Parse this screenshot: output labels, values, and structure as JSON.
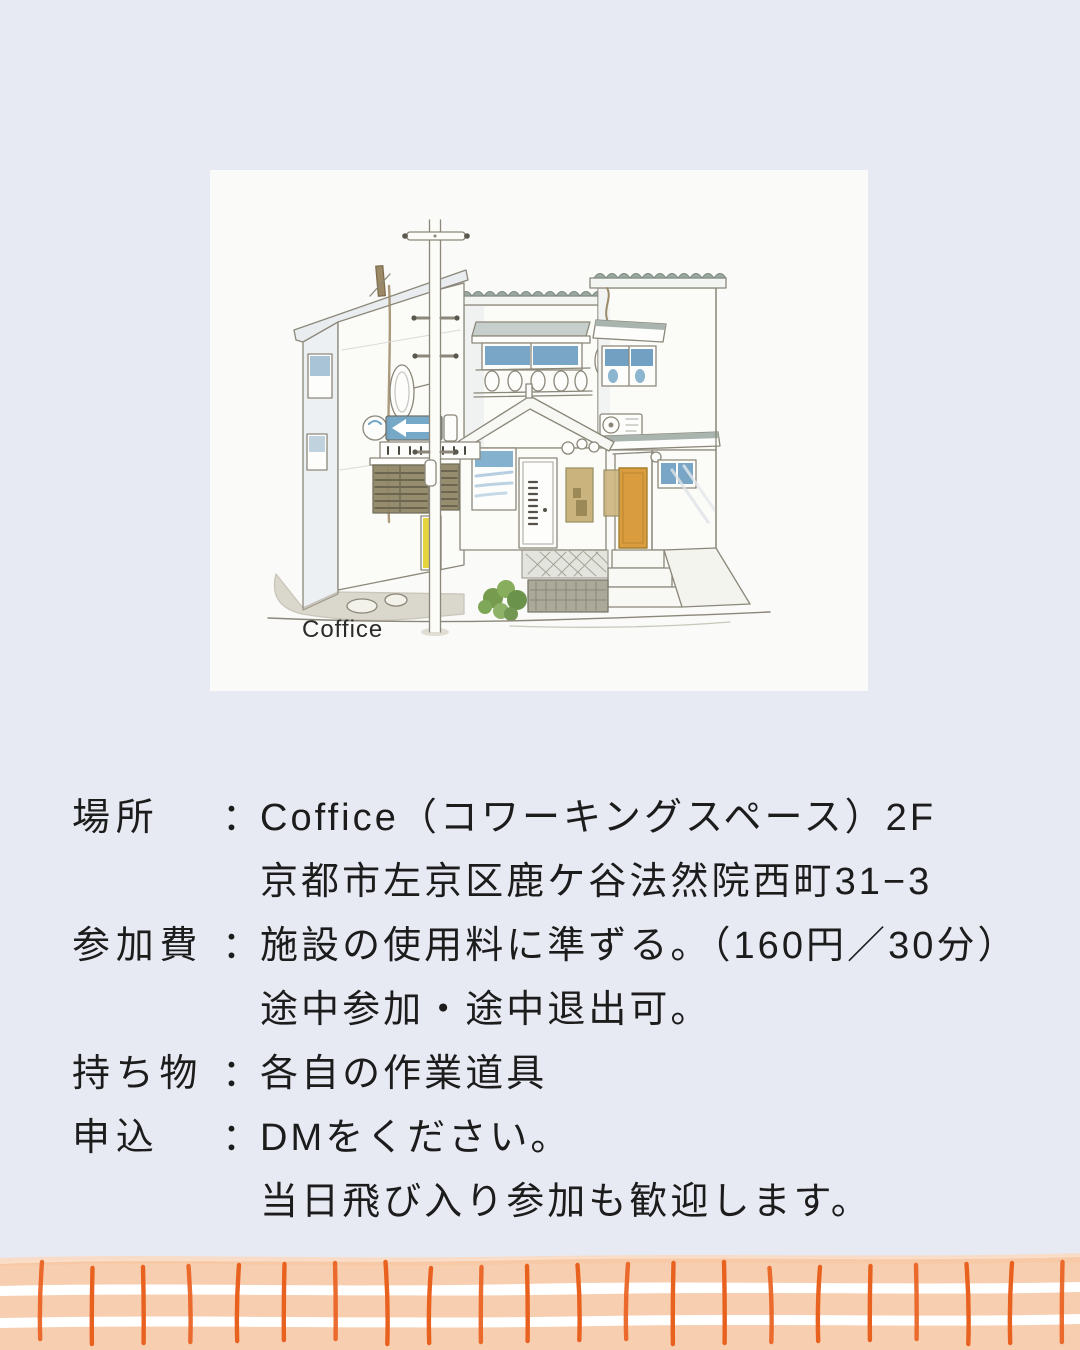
{
  "page": {
    "background": "#E8EAF3",
    "card_background": "#FAFAF8",
    "text_color": "#1C1C1C"
  },
  "card": {
    "illustration_caption": "Coffice"
  },
  "illustration": {
    "subject": "watercolor-sketch-of-coffice-building-exterior",
    "colors": {
      "line": "#8B877A",
      "window_blue": "#6296BC",
      "window_blue_light": "#7FAECB",
      "door_orange": "#D99C3E",
      "roof_green": "#9BA8A0",
      "bush_green": "#6B9440",
      "marker_yellow": "#E5D23F",
      "sign_blue": "#6FA4C6",
      "grille_brown": "#918767",
      "ground_taupe": "#BCB5A2"
    }
  },
  "details": {
    "rows": [
      {
        "label": "場所",
        "colon": "：",
        "lines": [
          "Coffice（コワーキングスペース）2F",
          "京都市左京区鹿ケ谷法然院西町31−3"
        ]
      },
      {
        "label": "参加費",
        "colon": "：",
        "lines": [
          "施設の使用料に準ずる。（160円／30分）",
          "途中参加・途中退出可。"
        ]
      },
      {
        "label": "持ち物",
        "colon": "：",
        "lines": [
          "各自の作業道具"
        ]
      },
      {
        "label": "申込",
        "colon": "：",
        "lines": [
          "DMをください。",
          "当日飛び入り参加も歓迎します。"
        ]
      }
    ]
  },
  "footer_border": {
    "background": "#FFFFFF",
    "band_color": "#F6C5A1",
    "band_light": "#FAD9BF",
    "stroke_color": "#E8611F",
    "stroke_count": 22
  }
}
